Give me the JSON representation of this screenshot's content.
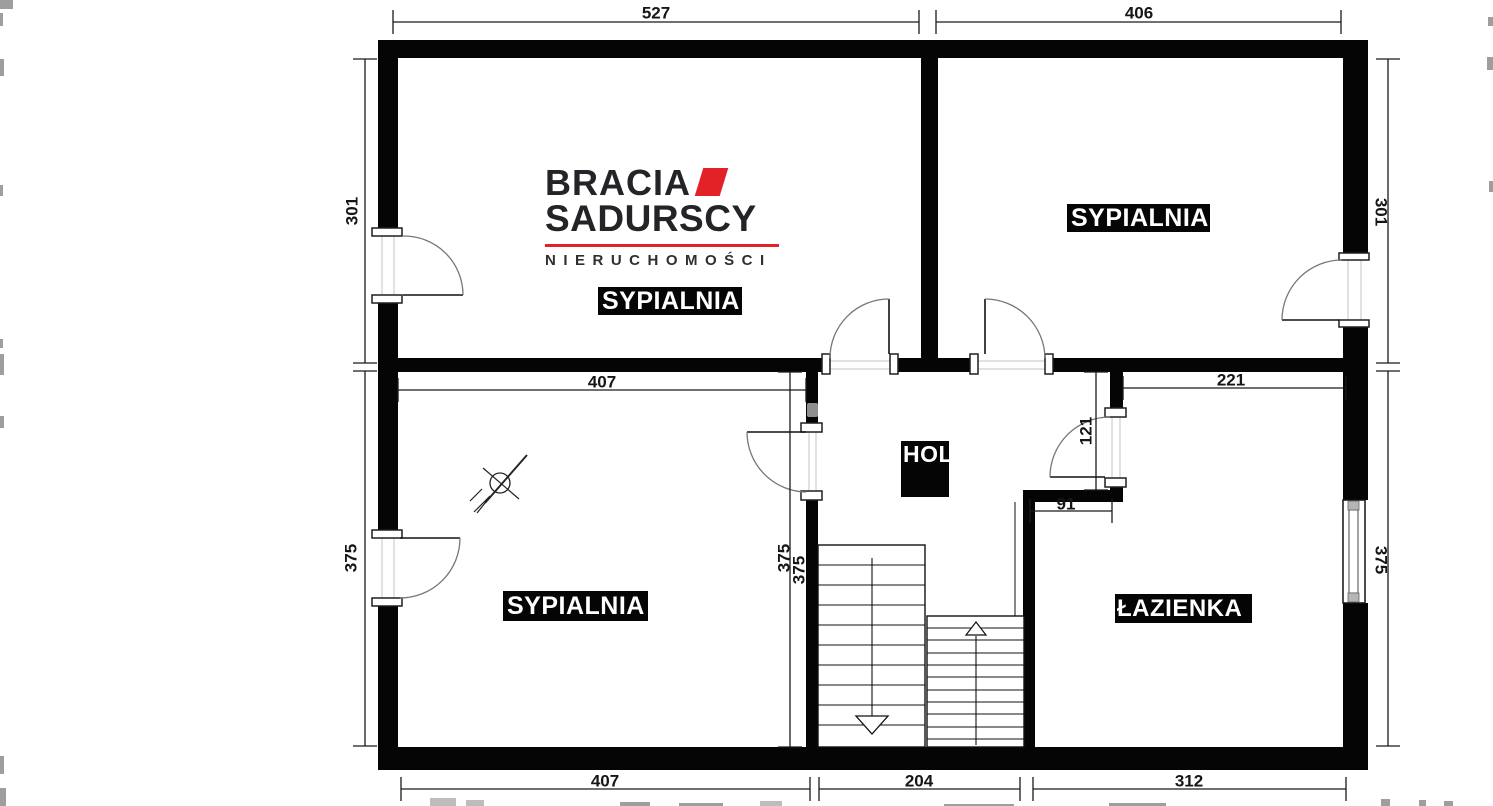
{
  "brand": {
    "line1": "BRACIA",
    "line2": "SADURSCY",
    "line3": "NIERUCHOMOŚCI",
    "accent_color": "#e32227",
    "text_color": "#232328"
  },
  "rooms": {
    "top_left": "SYPIALNIA",
    "top_right": "SYPIALNIA",
    "bottom_left": "SYPIALNIA",
    "hall": "HOL",
    "bathroom": "ŁAZIENKA"
  },
  "dims": {
    "top": {
      "left": "527",
      "right": "406"
    },
    "bottom": {
      "left": "407",
      "center": "204",
      "right": "312"
    },
    "side_left": {
      "upper": "301",
      "lower": "375"
    },
    "side_right": {
      "upper": "301",
      "lower": "375"
    },
    "inner": {
      "bedroom_width": "407",
      "bathroom_width": "221",
      "hall_opening": "121",
      "bath_nook": "91",
      "bedroom_height": "375",
      "hall_height": "375"
    }
  },
  "colors": {
    "wall": "#050505",
    "label_bg": "#050505",
    "label_text": "#ffffff",
    "dim_text": "#161616",
    "arc": "#777777",
    "accent": "#e32227"
  }
}
